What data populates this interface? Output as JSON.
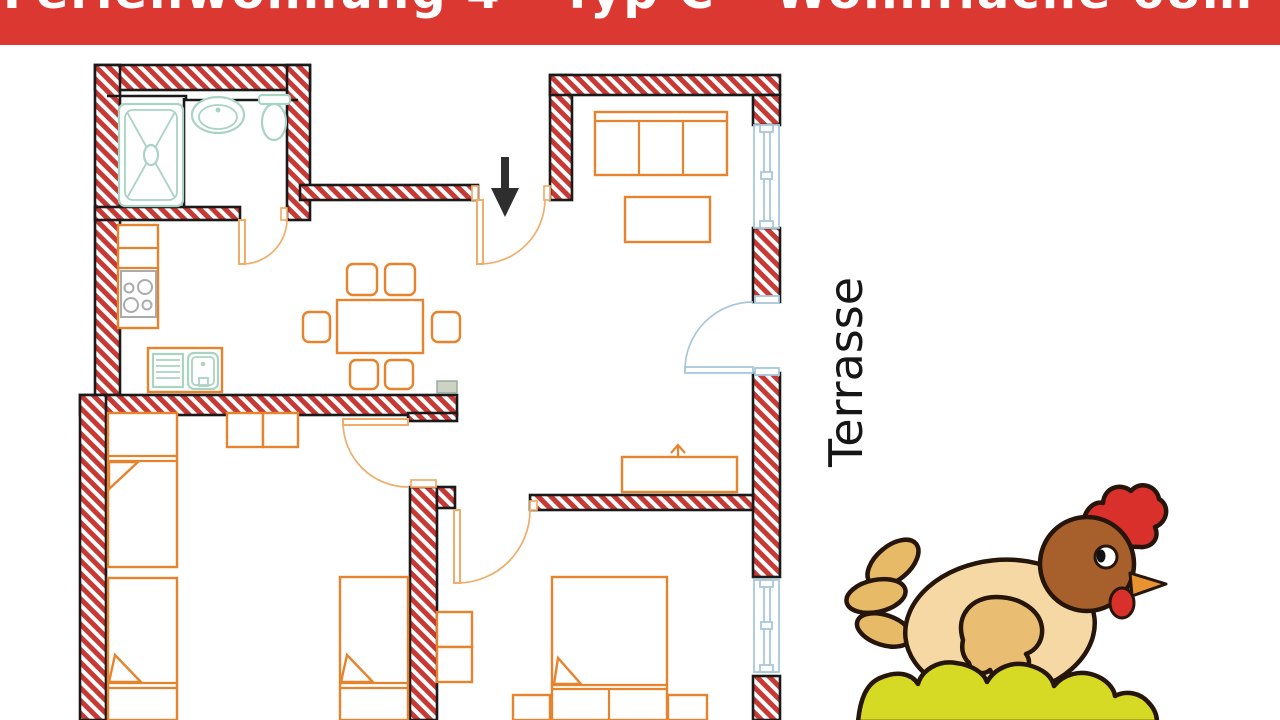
{
  "banner": {
    "title": "Ferienwohnung 4 - Typ C - Wohnfläche 68m²",
    "bg_color": "#DC3832",
    "text_color": "#FFFFFF",
    "note": "text partially cropped at top edge of screenshot"
  },
  "labels": {
    "terrace": "Terrasse"
  },
  "floorplan": {
    "type": "apartment floor plan",
    "rooms_depicted": [
      "bathroom",
      "kitchen",
      "dining area",
      "living room",
      "hallway",
      "bedroom with three single beds",
      "bedroom with double bed"
    ],
    "fixtures": [
      "shower",
      "washbasin",
      "toilet",
      "stove",
      "kitchen sink",
      "dining table with six chairs",
      "sofa",
      "coffee table",
      "sideboard",
      "wardrobe",
      "dresser",
      "single beds",
      "double bed",
      "nightstands",
      "radiator"
    ],
    "openings": [
      "entrance door with arrow",
      "bathroom door",
      "terrace door",
      "two bedroom doors",
      "living room window",
      "bedroom window"
    ]
  },
  "icons": {
    "entrance_arrow": "down-arrow",
    "chicken_illustration": "cartoon hen sitting on nest"
  },
  "colors": {
    "banner_red": "#DC3832",
    "wall_red": "#C63934",
    "furniture_orange": "#E8832D",
    "door_orange": "#F0AD6A",
    "fixture_teal": "#A9D3C3",
    "window_blue": "#A8C7DC",
    "outline_black": "#1A1A1A",
    "stove_gray": "#ABABAB",
    "chicken_body": "#F5D8A4",
    "chicken_head": "#A7602B",
    "chicken_wing": "#E9BE72",
    "comb_red": "#D9302B",
    "beak_orange": "#E8932F",
    "tail_tan": "#E6BA66",
    "nest_yellow": "#D7DA25",
    "chicken_outline": "#26150A"
  }
}
